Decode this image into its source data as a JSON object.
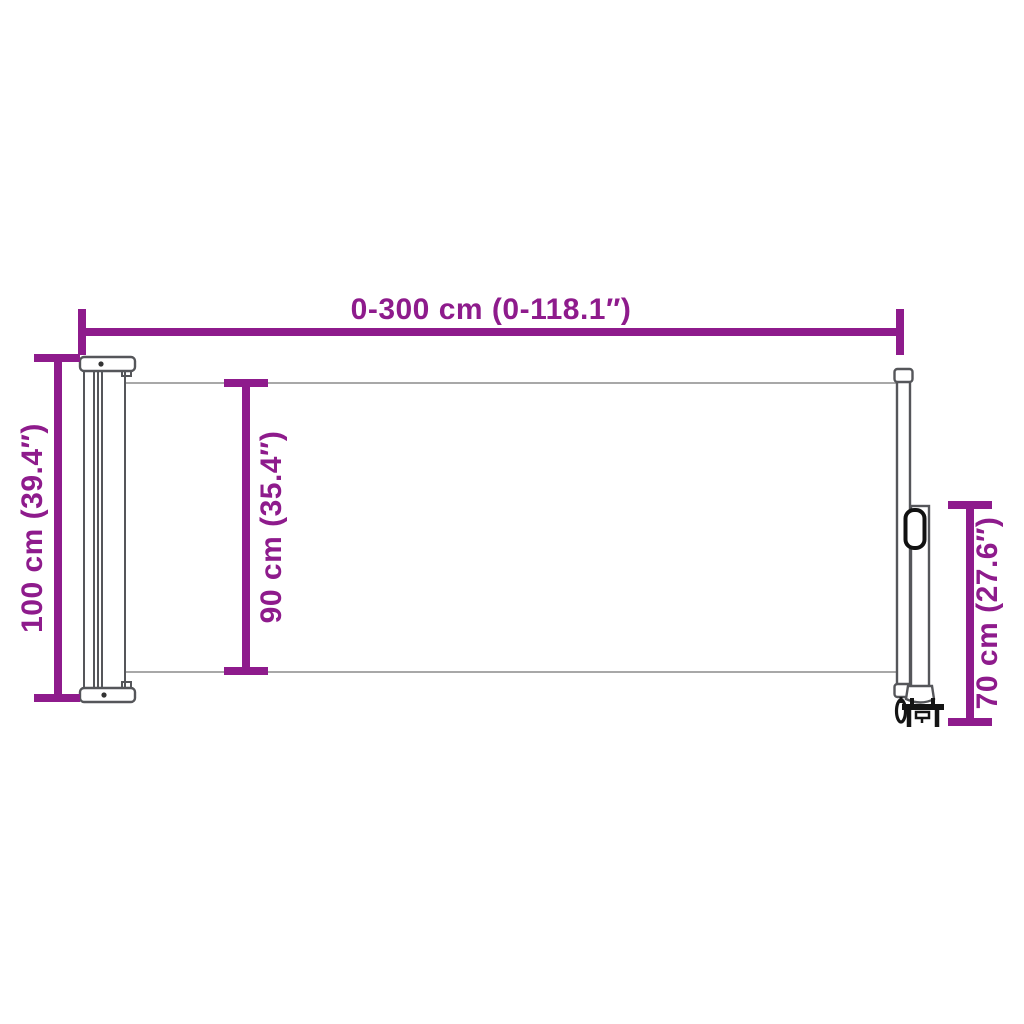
{
  "diagram": {
    "kind": "product-dimension-diagram",
    "subject": "retractable side awning, side view",
    "colors": {
      "accent": "#8E1B8C",
      "outline": "#55565A",
      "detail": "#141414",
      "background": "#FFFFFF"
    },
    "dimensions": {
      "extension_width": {
        "label": "0-300 cm (0-118.1″)",
        "orientation": "horizontal",
        "position": "top"
      },
      "total_height": {
        "label": "100 cm (39.4″)",
        "orientation": "vertical",
        "position": "left"
      },
      "fabric_height": {
        "label": "90 cm (35.4″)",
        "orientation": "vertical",
        "position": "middle"
      },
      "post_height": {
        "label": "70 cm (27.6″)",
        "orientation": "vertical",
        "position": "right"
      }
    }
  }
}
